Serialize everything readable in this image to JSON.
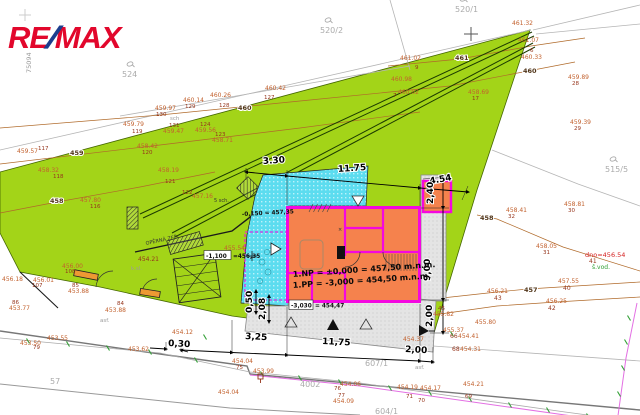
{
  "logo": {
    "re": "RE",
    "slash": "/",
    "max": "MAX",
    "stamp": "75094"
  },
  "colors": {
    "parcel_green": "#A3D418",
    "terrace_cyan": "#5CDCEF",
    "building_orange": "#F5824D",
    "wall_magenta": "#F407E0",
    "utility_magenta": "#E36FE3",
    "utility_green": "#2F9E33",
    "contour_brown": "#B06A2A",
    "spot_orange": "#C2612E",
    "logo_red": "#E2072C",
    "logo_blue": "#1C3E8E"
  },
  "elevation_notes": {
    "np": "1.NP = ±0,000 = 457,50 m.n.m.",
    "pp": "1.PP = -3,000 = 454,50 m.n.m.",
    "entry": "-0,150 = 457,35",
    "terrace_box": "-1,100",
    "terrace_val": "=456,35",
    "base_box": "-3,030",
    "base_val": "= 454,47"
  },
  "dimensions": [
    {
      "label": "3.30",
      "x": 263,
      "y": 164,
      "rot": -4
    },
    {
      "label": "11.75",
      "x": 338,
      "y": 172,
      "rot": -4
    },
    {
      "label": "4.54",
      "x": 430,
      "y": 184,
      "rot": -10
    },
    {
      "label": "2,40",
      "x": 433,
      "y": 204,
      "rot": -90
    },
    {
      "label": "9,00",
      "x": 430,
      "y": 281,
      "rot": -90
    },
    {
      "label": "2,00",
      "x": 432,
      "y": 327,
      "rot": -90
    },
    {
      "label": "0,50",
      "x": 252,
      "y": 313,
      "rot": -90
    },
    {
      "label": "2,08",
      "x": 265,
      "y": 320,
      "rot": -90
    },
    {
      "label": "0,30",
      "x": 168,
      "y": 346,
      "rot": 3
    },
    {
      "label": "3,25",
      "x": 245,
      "y": 339,
      "rot": 3
    },
    {
      "label": "11,75",
      "x": 322,
      "y": 344,
      "rot": 3
    },
    {
      "label": "2,00",
      "x": 405,
      "y": 352,
      "rot": 3
    }
  ],
  "contour_labels": [
    {
      "label": "461",
      "x": 455,
      "y": 60
    },
    {
      "label": "460",
      "x": 238,
      "y": 110
    },
    {
      "label": "460",
      "x": 523,
      "y": 73
    },
    {
      "label": "459",
      "x": 70,
      "y": 155
    },
    {
      "label": "458",
      "x": 50,
      "y": 203
    },
    {
      "label": "458",
      "x": 480,
      "y": 220
    },
    {
      "label": "457",
      "x": 524,
      "y": 292
    }
  ],
  "parcel_labels": [
    {
      "label": "524",
      "x": 122,
      "y": 77,
      "sym": true
    },
    {
      "label": "520/2",
      "x": 320,
      "y": 33,
      "sym": true
    },
    {
      "label": "520/1",
      "x": 455,
      "y": 12,
      "sym": true
    },
    {
      "label": "515/5",
      "x": 605,
      "y": 172,
      "sym": true
    },
    {
      "label": "607/1",
      "x": 365,
      "y": 366,
      "sym": false
    },
    {
      "label": "604/1",
      "x": 375,
      "y": 414,
      "sym": false
    },
    {
      "label": "57",
      "x": 50,
      "y": 384,
      "sym": false
    },
    {
      "label": "4002",
      "x": 300,
      "y": 387,
      "sym": false
    }
  ],
  "spot_heights": [
    {
      "v": "461.32",
      "x": 512,
      "y": 25
    },
    {
      "v": "461.07",
      "x": 518,
      "y": 42
    },
    {
      "v": "460.33",
      "x": 521,
      "y": 59,
      "id": "6",
      "ix": 530,
      "iy": 52
    },
    {
      "v": "461.02",
      "x": 400,
      "y": 60,
      "id": "9",
      "ix": 415,
      "iy": 69
    },
    {
      "v": "460.98",
      "x": 391,
      "y": 81
    },
    {
      "v": "460.02",
      "x": 398,
      "y": 94,
      "id": "7",
      "ix": 393,
      "iy": 97
    },
    {
      "v": "458.69",
      "x": 468,
      "y": 94,
      "id": "17",
      "ix": 472,
      "iy": 100
    },
    {
      "v": "459.89",
      "x": 568,
      "y": 79,
      "id": "28",
      "ix": 572,
      "iy": 85
    },
    {
      "v": "459.39",
      "x": 570,
      "y": 124,
      "id": "29",
      "ix": 574,
      "iy": 130
    },
    {
      "v": "458.81",
      "x": 564,
      "y": 206,
      "id": "30",
      "ix": 568,
      "iy": 212
    },
    {
      "v": "458.41",
      "x": 506,
      "y": 212,
      "id": "32",
      "ix": 508,
      "iy": 218
    },
    {
      "v": "458.05",
      "x": 536,
      "y": 248,
      "id": "31",
      "ix": 543,
      "iy": 254
    },
    {
      "v": "457.55",
      "x": 558,
      "y": 283,
      "id": "40",
      "ix": 563,
      "iy": 290,
      "idcls": "darkred"
    },
    {
      "v": "456.21",
      "x": 487,
      "y": 293,
      "id": "43",
      "ix": 494,
      "iy": 300,
      "idcls": "darkred"
    },
    {
      "v": "456.25",
      "x": 546,
      "y": 303,
      "id": "42",
      "ix": 548,
      "iy": 310,
      "idcls": "darkred"
    },
    {
      "v": "455.80",
      "x": 475,
      "y": 324
    },
    {
      "v": "455.82",
      "x": 433,
      "y": 316,
      "id": "45",
      "ix": 438,
      "iy": 310
    },
    {
      "v": "455.37",
      "x": 443,
      "y": 332
    },
    {
      "v": "460.42",
      "x": 265,
      "y": 90,
      "id": "127",
      "ix": 264,
      "iy": 99
    },
    {
      "v": "460.26",
      "x": 210,
      "y": 97,
      "id": "128",
      "ix": 219,
      "iy": 107
    },
    {
      "v": "460.14",
      "x": 183,
      "y": 102,
      "id": "129",
      "ix": 185,
      "iy": 108
    },
    {
      "v": "459.97",
      "x": 155,
      "y": 110,
      "id": "130",
      "ix": 156,
      "iy": 116
    },
    {
      "v": "459.79",
      "x": 123,
      "y": 126,
      "id": "119",
      "ix": 132,
      "iy": 133
    },
    {
      "v": "459.47",
      "x": 163,
      "y": 133,
      "id": "131",
      "ix": 169,
      "iy": 127
    },
    {
      "v": "459.56",
      "x": 195,
      "y": 132,
      "id": "124",
      "ix": 200,
      "iy": 126
    },
    {
      "v": "458.71",
      "x": 212,
      "y": 142,
      "id": "123",
      "ix": 215,
      "iy": 136
    },
    {
      "v": "459.57",
      "x": 17,
      "y": 153,
      "id": "117",
      "ix": 38,
      "iy": 150
    },
    {
      "v": "458.42",
      "x": 137,
      "y": 148,
      "id": "120",
      "ix": 142,
      "iy": 154
    },
    {
      "v": "458.19",
      "x": 158,
      "y": 172,
      "id": "121",
      "ix": 165,
      "iy": 183
    },
    {
      "v": "458.32",
      "x": 38,
      "y": 172,
      "id": "118",
      "ix": 53,
      "iy": 178
    },
    {
      "v": "457.80",
      "x": 80,
      "y": 202,
      "id": "116",
      "ix": 90,
      "iy": 208
    },
    {
      "v": "457.16",
      "x": 192,
      "y": 198,
      "id": "122",
      "ix": 182,
      "iy": 194
    },
    {
      "v": "455.54",
      "x": 224,
      "y": 250
    },
    {
      "v": "454.21",
      "x": 138,
      "y": 261,
      "cls": "darkred"
    },
    {
      "v": "456.18",
      "x": 2,
      "y": 281
    },
    {
      "v": "456.00",
      "x": 62,
      "y": 268,
      "id": "108",
      "ix": 65,
      "iy": 273
    },
    {
      "v": "456.01",
      "x": 33,
      "y": 282,
      "id": "107",
      "ix": 32,
      "iy": 287
    },
    {
      "v": "453.88",
      "x": 68,
      "y": 293,
      "id": "85",
      "ix": 72,
      "iy": 287
    },
    {
      "v": "453.77",
      "x": 9,
      "y": 310,
      "id": "86",
      "ix": 12,
      "iy": 304
    },
    {
      "v": "453.88",
      "x": 105,
      "y": 312,
      "id": "84",
      "ix": 117,
      "iy": 305
    },
    {
      "v": "453.55",
      "x": 47,
      "y": 340
    },
    {
      "v": "453.50",
      "x": 20,
      "y": 345,
      "id": "79",
      "ix": 33,
      "iy": 349
    },
    {
      "v": "453.62",
      "x": 128,
      "y": 351
    },
    {
      "v": "454.12",
      "x": 172,
      "y": 334
    },
    {
      "v": "454.04",
      "x": 232,
      "y": 363,
      "id": "75",
      "ix": 236,
      "iy": 369
    },
    {
      "v": "453.99",
      "x": 253,
      "y": 373
    },
    {
      "v": "454.04",
      "x": 218,
      "y": 394
    },
    {
      "v": "454.06",
      "x": 340,
      "y": 386,
      "id": "76",
      "ix": 334,
      "iy": 390
    },
    {
      "v": "454.09",
      "x": 333,
      "y": 403,
      "id": "77",
      "ix": 338,
      "iy": 397
    },
    {
      "v": "454.37",
      "x": 403,
      "y": 341
    },
    {
      "v": "454.41",
      "x": 458,
      "y": 338,
      "id": "66",
      "ix": 450,
      "iy": 338,
      "idcls": "darkred"
    },
    {
      "v": "454.31",
      "x": 460,
      "y": 351,
      "id": "68",
      "ix": 452,
      "iy": 351,
      "idcls": "darkred"
    },
    {
      "v": "454.19",
      "x": 397,
      "y": 389,
      "id": "71",
      "ix": 406,
      "iy": 398
    },
    {
      "v": "454.17",
      "x": 420,
      "y": 390,
      "id": "70",
      "ix": 418,
      "iy": 402
    },
    {
      "v": "454.21",
      "x": 463,
      "y": 386,
      "id": "69",
      "ix": 465,
      "iy": 398
    }
  ],
  "misc_texts": [
    {
      "t": "dno=456.54",
      "x": 585,
      "y": 257,
      "cls": "red"
    },
    {
      "t": "41",
      "x": 589,
      "y": 263,
      "cls": "darkred"
    },
    {
      "t": "š.vod.",
      "x": 592,
      "y": 269,
      "cls": "green"
    },
    {
      "t": "asf.",
      "x": 100,
      "y": 322,
      "cls": "gray-xs"
    },
    {
      "t": "asf.",
      "x": 415,
      "y": 369,
      "cls": "gray-xs"
    },
    {
      "t": "k.sl.",
      "x": 131,
      "y": 270,
      "cls": "gray-xs"
    },
    {
      "t": "sch",
      "x": 170,
      "y": 120,
      "cls": "gray-xs"
    },
    {
      "t": "5 sch.",
      "x": 214,
      "y": 202,
      "cls": "dark-xs"
    },
    {
      "t": "OPĚRNÁ ZEĎ",
      "x": 146,
      "y": 245,
      "cls": "dark-xs",
      "rot": -12
    },
    {
      "t": "×",
      "x": 338,
      "y": 231,
      "cls": "dark-xs"
    },
    {
      "t": "75094",
      "x": 31,
      "y": 73,
      "cls": "gray-sm",
      "rot": -90
    }
  ]
}
